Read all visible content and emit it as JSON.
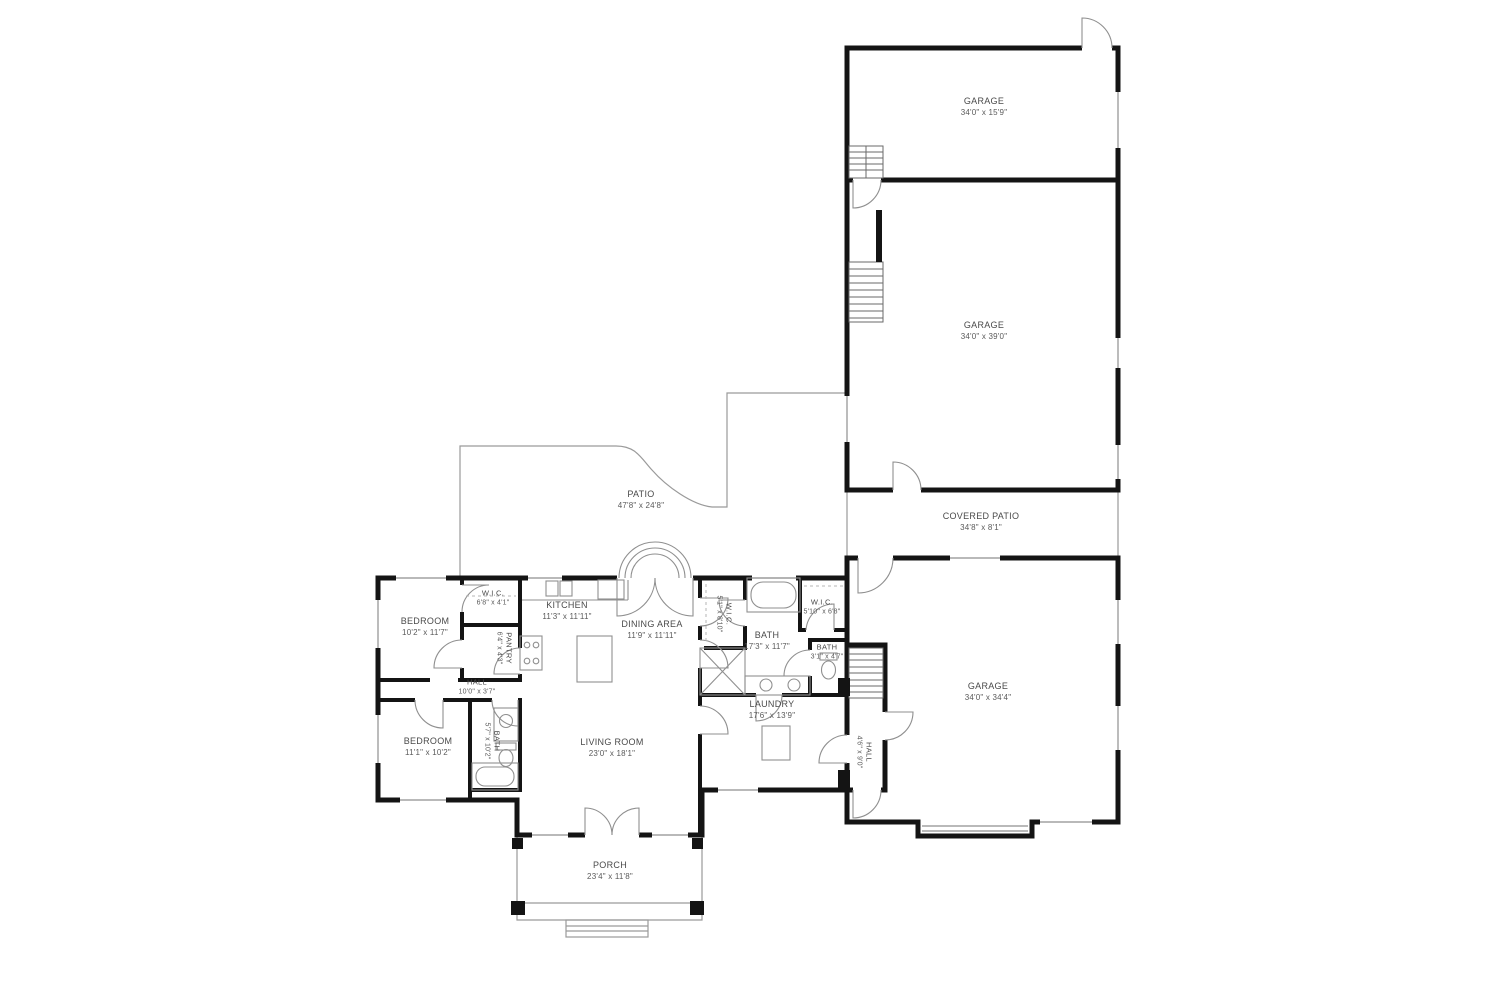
{
  "drawing": {
    "type": "residential-floor-plan",
    "background": "#ffffff",
    "wall_color": "#141414",
    "thin_line_color": "#8f8f8f",
    "label_color": "#4a4a4a"
  },
  "rooms": [
    {
      "id": "garage-top",
      "name": "GARAGE",
      "dims": "34'0\" x 15'9\""
    },
    {
      "id": "garage-middle",
      "name": "GARAGE",
      "dims": "34'0\" x 39'0\""
    },
    {
      "id": "covered-patio",
      "name": "COVERED PATIO",
      "dims": "34'8\" x 8'1\""
    },
    {
      "id": "garage-right",
      "name": "GARAGE",
      "dims": "34'0\" x 34'4\""
    },
    {
      "id": "patio",
      "name": "PATIO",
      "dims": "47'8\" x 24'8\""
    },
    {
      "id": "wic-top",
      "name": "W.I.C.",
      "dims": "6'8\" x 4'1\""
    },
    {
      "id": "kitchen",
      "name": "KITCHEN",
      "dims": "11'3\" x 11'11\""
    },
    {
      "id": "dining-area",
      "name": "DINING AREA",
      "dims": "11'9\" x 11'11\""
    },
    {
      "id": "pantry",
      "name": "PANTRY",
      "dims": "6'4\" x 4'3\""
    },
    {
      "id": "bedroom-top",
      "name": "BEDROOM",
      "dims": "10'2\" x 11'7\""
    },
    {
      "id": "hall",
      "name": "HALL",
      "dims": "10'0\" x 3'7\""
    },
    {
      "id": "bedroom-bottom",
      "name": "BEDROOM",
      "dims": "11'1\" x 10'2\""
    },
    {
      "id": "bath-left",
      "name": "BATH",
      "dims": "5'7\" x 10'2\""
    },
    {
      "id": "living-room",
      "name": "LIVING ROOM",
      "dims": "23'0\" x 18'1\""
    },
    {
      "id": "porch",
      "name": "PORCH",
      "dims": "23'4\" x 11'8\""
    },
    {
      "id": "wic-middle",
      "name": "W.I.C.",
      "dims": "5'1\" x 8'10\""
    },
    {
      "id": "wic-right",
      "name": "W.I.C.",
      "dims": "5'10\" x 6'8\""
    },
    {
      "id": "bath-master",
      "name": "BATH",
      "dims": "17'3\" x 11'7\""
    },
    {
      "id": "bath-small",
      "name": "BATH",
      "dims": "3'1\" x 4'7\""
    },
    {
      "id": "laundry",
      "name": "LAUNDRY",
      "dims": "17'6\" x 13'9\""
    },
    {
      "id": "hall-right",
      "name": "HALL",
      "dims": "4'6\" x 9'0\""
    }
  ]
}
